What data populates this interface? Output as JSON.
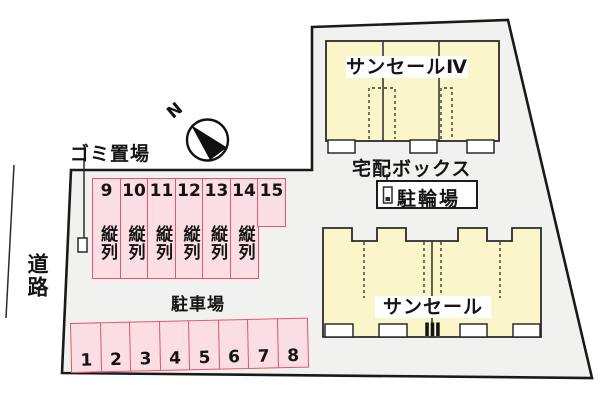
{
  "labels": {
    "road": "道路",
    "garbage": "ゴミ置場",
    "delivery_box": "宅配ボックス",
    "bicycle_parking": "駐輪場",
    "parking_lot": "駐車場",
    "tandem": "縦列",
    "north": "N"
  },
  "buildings": [
    {
      "name": "サンセールⅣ"
    },
    {
      "name": "サンセールⅢ"
    }
  ],
  "parking": {
    "upper_spaces": [
      "9",
      "10",
      "11",
      "12",
      "13",
      "14",
      "15"
    ],
    "lower_spaces": [
      "1",
      "2",
      "3",
      "4",
      "5",
      "6",
      "7",
      "8"
    ]
  },
  "colors": {
    "site_fill": "#f1f1ef",
    "building_fill": "#faf6ca",
    "parking_fill": "#fbdde4",
    "parking_border": "#e05a68",
    "outline": "#1a1a1a"
  }
}
